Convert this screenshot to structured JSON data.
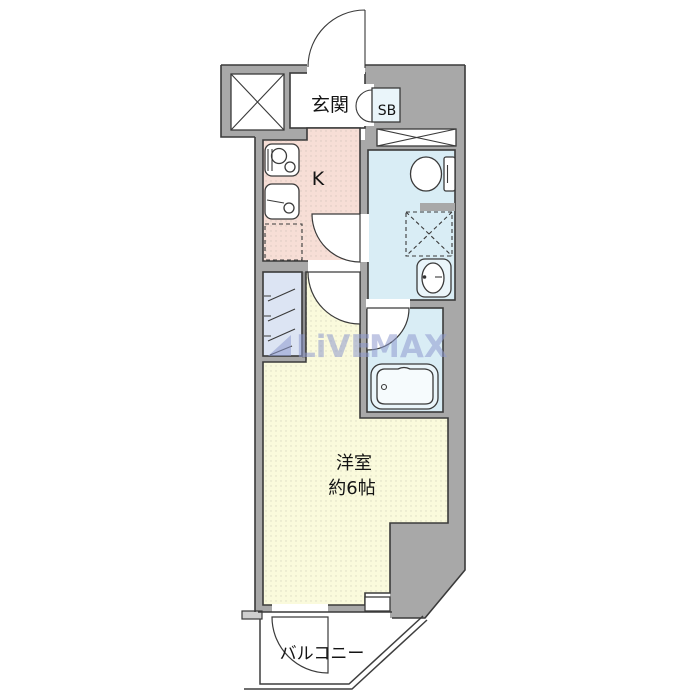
{
  "plan": {
    "type": "apartment-floorplan",
    "labels": {
      "entrance": "玄関",
      "shoe_box": "SB",
      "kitchen": "K",
      "main_room": "洋室",
      "main_room_size": "約6帖",
      "balcony": "バルコニー"
    },
    "watermark": {
      "brand_1": "LiVE",
      "brand_2": "MAX"
    },
    "icons": {
      "shaft-x-icon": "crossed box (elevator/pipe shaft)",
      "vent-strip-icon": "crossed narrow strip (void)",
      "stove-icon": "two-burner gas stove",
      "sink-icon": "kitchen sink",
      "fridge-space-icon": "dashed refrigerator space",
      "toilet-icon": "toilet with tank",
      "washer-pan-icon": "dashed washing machine pan with cross",
      "washbasin-icon": "washbasin with oval bowl",
      "bathtub-icon": "bathtub with drain",
      "closet-hanger-icon": "closet hanger slash marks",
      "door-arc-icon": "door swing quarter-circle"
    }
  },
  "colors": {
    "wall": "#a8a8a8",
    "wall_mid": "#8f8f8f",
    "wall_light": "#cfcfcf",
    "outline": "#3a3a3a",
    "entrance_floor": "#ffffff",
    "kitchen_floor": "#f7ded6",
    "wet_floor": "#d9edf5",
    "closet_floor": "#dce4f3",
    "room_floor": "#fafadc",
    "balcony_floor": "#ffffff",
    "fixture": "#eaf5fa",
    "watermark": "#8f9bcf"
  }
}
